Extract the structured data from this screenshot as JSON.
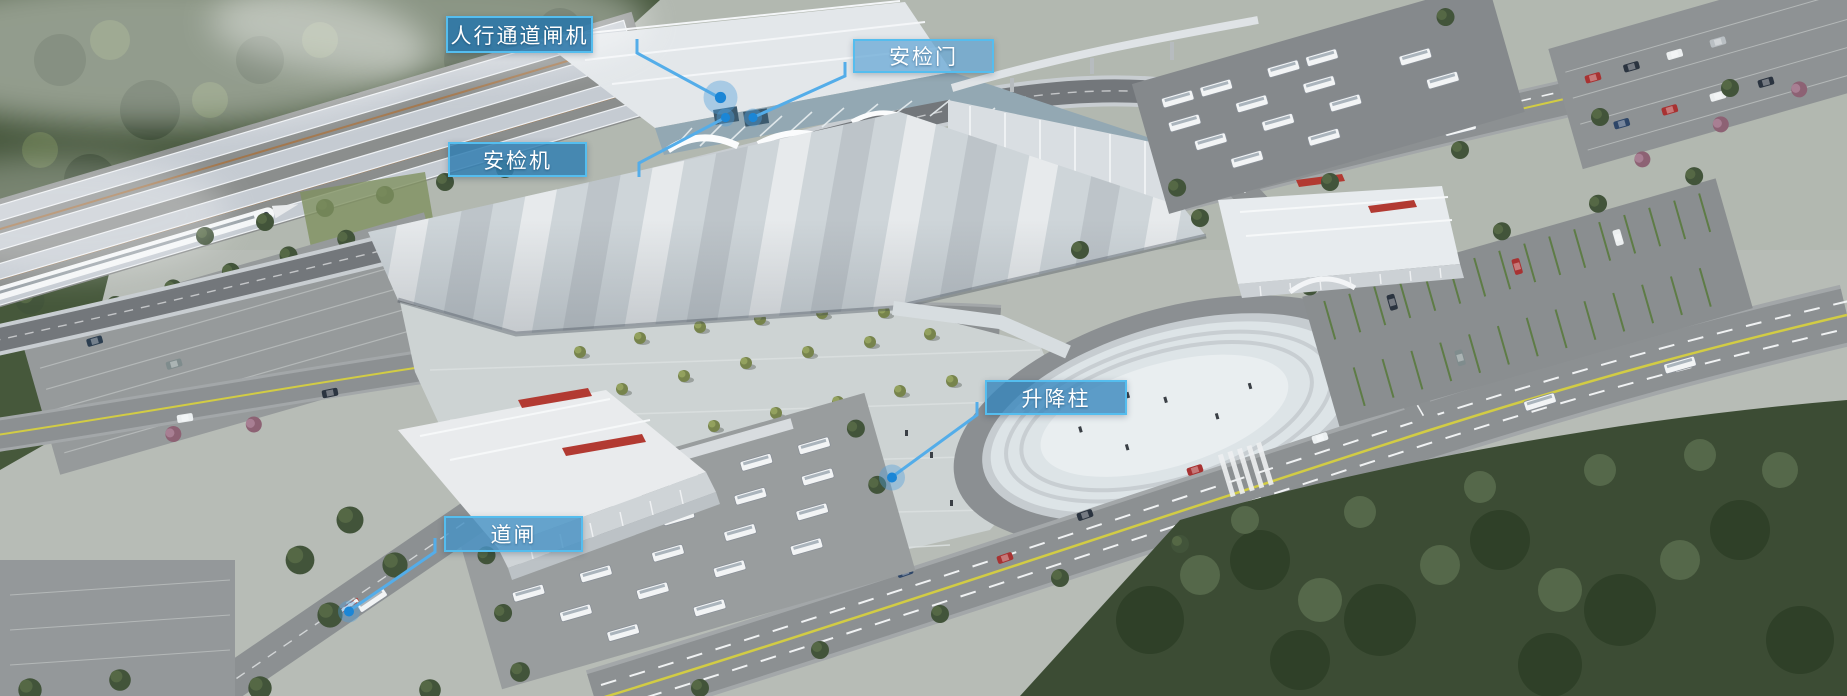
{
  "scene": {
    "description": "高铁站园区鸟瞰渲染图：上方为铁路站台与候车大厅，中部大型落客雨棚与站前广场，右侧环形落客环岛与主干道，左下为公交停车场与客运站楼，四周绿化林带",
    "palette": {
      "label_border": "#55bdee",
      "leader_line": "#54ade9",
      "dot_fill": "#1b86d6",
      "dot_halo": "rgba(80,160,220,0.4)",
      "road_yellow_line": "#d2cc44",
      "red_sign": "#b23a32"
    }
  },
  "callouts": [
    {
      "id": "pedestrian-gate",
      "label": "人行通道闸机",
      "box": {
        "x": 446,
        "y": 16,
        "w": 147,
        "h": 37
      },
      "fill": "rgba(42,118,168,0.88)",
      "line": [
        [
          637,
          39
        ],
        [
          637,
          53
        ],
        [
          720,
          98
        ]
      ],
      "dot": {
        "x": 720.5,
        "y": 97.5,
        "r": 5.6,
        "halo": 17
      }
    },
    {
      "id": "security-door",
      "label": "安检门",
      "box": {
        "x": 853,
        "y": 39,
        "w": 141,
        "h": 34
      },
      "fill": "rgba(104,168,214,0.75)",
      "line": [
        [
          845,
          62
        ],
        [
          845,
          76
        ],
        [
          753,
          117.5
        ]
      ],
      "dot": {
        "x": 753,
        "y": 117.5,
        "r": 4.6,
        "halo": 9
      }
    },
    {
      "id": "security-machine",
      "label": "安检机",
      "box": {
        "x": 448,
        "y": 142,
        "w": 139,
        "h": 35
      },
      "fill": "rgba(50,127,178,0.85)",
      "line": [
        [
          639,
          177
        ],
        [
          639,
          163
        ],
        [
          725.5,
          117.5
        ]
      ],
      "dot": {
        "x": 725.5,
        "y": 117.5,
        "r": 4.6,
        "halo": 9
      }
    },
    {
      "id": "bollard",
      "label": "升降柱",
      "box": {
        "x": 985,
        "y": 380,
        "w": 142,
        "h": 35
      },
      "fill": "rgba(52,133,188,0.78)",
      "line": [
        [
          977,
          402
        ],
        [
          977,
          415
        ],
        [
          892,
          477
        ]
      ],
      "dot": {
        "x": 892,
        "y": 477.5,
        "r": 5,
        "halo": 13
      }
    },
    {
      "id": "barrier-gate",
      "label": "道闸",
      "box": {
        "x": 444,
        "y": 516,
        "w": 139,
        "h": 36
      },
      "fill": "rgba(72,146,196,0.82)",
      "line": [
        [
          435,
          538
        ],
        [
          435,
          552
        ],
        [
          349,
          611
        ]
      ],
      "dot": {
        "x": 349,
        "y": 611.5,
        "r": 5,
        "halo": 11
      }
    }
  ]
}
